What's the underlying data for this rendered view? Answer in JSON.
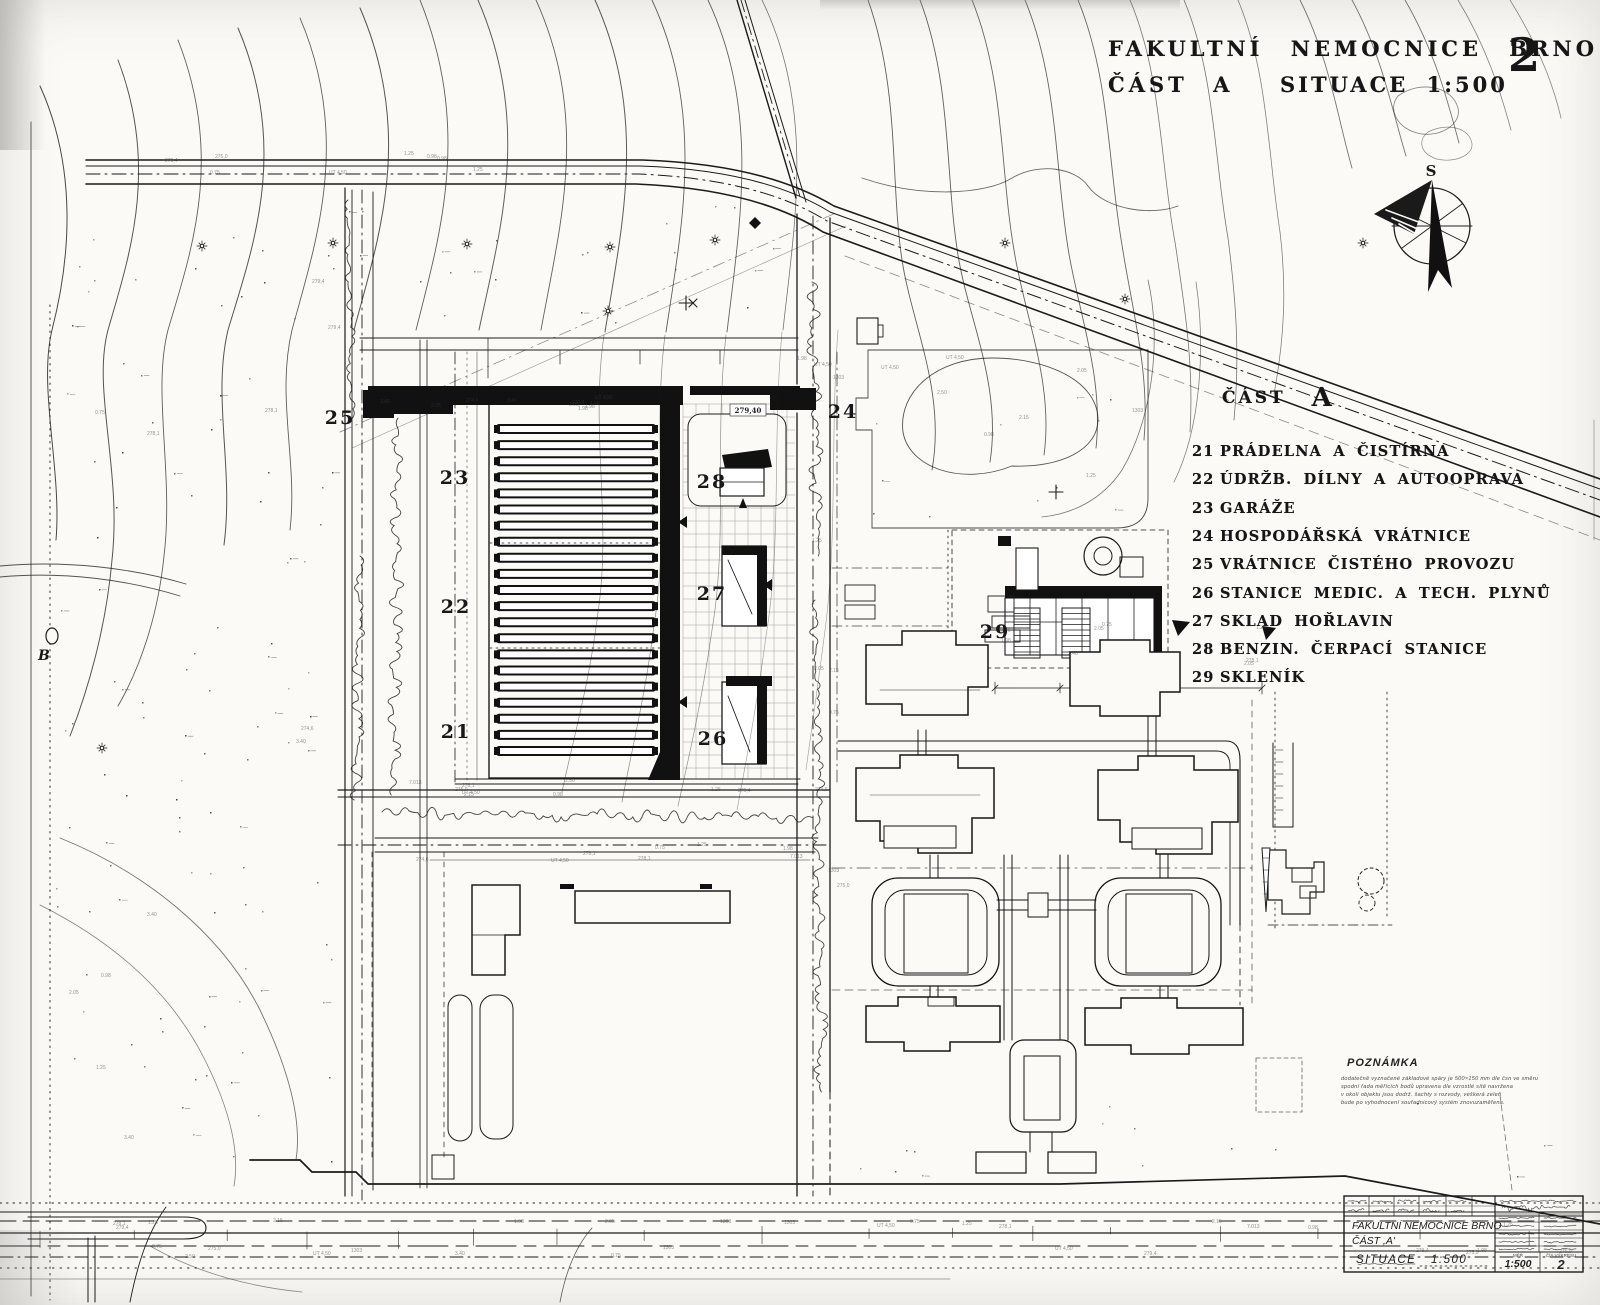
{
  "sheet": {
    "title_line1": "FAKULTNÍ NEMOCNICE BRNO",
    "title_part": "ČÁST A",
    "title_scale": "SITUACE 1:500",
    "sheet_number": "2"
  },
  "compass": {
    "north_label": "S"
  },
  "legend": {
    "header_word": "ČÁST",
    "header_letter": "A",
    "items": [
      {
        "num": "21",
        "label": "PRÁDELNA A ČISTÍRNA"
      },
      {
        "num": "22",
        "label": "ÚDRŽB. DÍLNY A AUTOOPRAVA"
      },
      {
        "num": "23",
        "label": "GARÁŽE"
      },
      {
        "num": "24",
        "label": "HOSPODÁŘSKÁ VRÁTNICE"
      },
      {
        "num": "25",
        "label": "VRÁTNICE ČISTÉHO PROVOZU"
      },
      {
        "num": "26",
        "label": "STANICE MEDIC. A TECH. PLYNŮ"
      },
      {
        "num": "27",
        "label": "SKLAD HOŘLAVIN"
      },
      {
        "num": "28",
        "label": "BENZIN. ČERPACÍ STANICE"
      },
      {
        "num": "29",
        "label": "SKLENÍK"
      }
    ]
  },
  "plan_labels": [
    "21",
    "22",
    "23",
    "24",
    "25",
    "26",
    "27",
    "28",
    "29"
  ],
  "benchmark_label": "B",
  "annotations": {
    "elevation_box": "279,40"
  },
  "note": {
    "heading": "POZNÁMKA",
    "lines": [
      "dodatečně vyznačené základové spáry je 500×150 mm dle čsn ve směru",
      "spodní řada měřících bodů upravena dle vzrostlé sítě navržena",
      "v okolí objektu jsou dodrž. šachty s rozvody, veškerá zeleň",
      "bude po vyhodnocení souřadnicový systém znovuzaměřena."
    ]
  },
  "title_block": {
    "project": "FAKULTNÍ NEMOCNICE BRNO",
    "part": "ČÁST ,A'",
    "drawing": "SITUACE 1:500",
    "scale_label": "MĚŘ",
    "scale_value": "1:500",
    "number_label": "ČÍS VÝKRESU",
    "number_value": "2"
  }
}
